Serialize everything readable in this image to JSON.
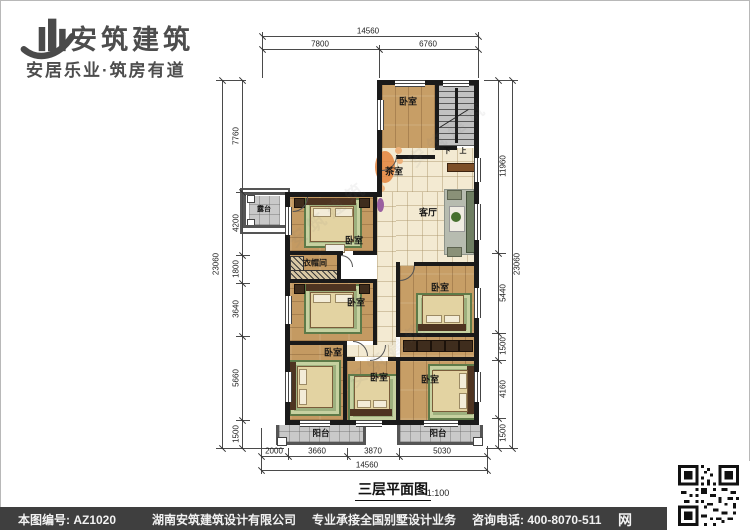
{
  "brand": {
    "name": "安筑建筑",
    "tagline": "安居乐业·筑房有道"
  },
  "plan": {
    "title": "三层平面图",
    "scale": "1:100",
    "rooms": [
      {
        "key": "bedroom-top",
        "label": "卧室"
      },
      {
        "key": "tea-room",
        "label": "茶室"
      },
      {
        "key": "living-room",
        "label": "客厅"
      },
      {
        "key": "bedroom-mid-left",
        "label": "卧室"
      },
      {
        "key": "cloakroom",
        "label": "衣帽间"
      },
      {
        "key": "bedroom-left-lower",
        "label": "卧室"
      },
      {
        "key": "bedroom-mid-right",
        "label": "卧室"
      },
      {
        "key": "bedroom-bottom-left",
        "label": "卧室"
      },
      {
        "key": "bedroom-bottom-middle",
        "label": "卧室"
      },
      {
        "key": "bedroom-bottom-right",
        "label": "卧室"
      },
      {
        "key": "terrace",
        "label": "露台"
      },
      {
        "key": "balcony-left",
        "label": "阳台"
      },
      {
        "key": "balcony-right",
        "label": "阳台"
      }
    ],
    "stairs": {
      "up": "上",
      "down": "下"
    },
    "dimensions": {
      "top": {
        "overall": "14560",
        "segments": [
          "7800",
          "6760"
        ]
      },
      "bottom": {
        "overall": "14560",
        "segments": [
          "2000",
          "3660",
          "3870",
          "5030"
        ]
      },
      "left": {
        "overall": "23060",
        "segments": [
          "7760",
          "4200",
          "1800",
          "3640",
          "5660",
          "1500"
        ]
      },
      "right": {
        "overall": "23060",
        "segments": [
          "11960",
          "5440",
          "1500",
          "4160",
          "1500"
        ]
      }
    }
  },
  "watermark": "安筑建筑",
  "footer": {
    "drawing_no": "本图编号: AZ1020",
    "company": "湖南安筑建筑设计有限公司",
    "service": "专业承接全国别墅设计业务",
    "phone": "咨询电话: 400-8070-511",
    "web_badge": "网"
  },
  "colors": {
    "wood": "#c79e66",
    "tile": "#f3ead2",
    "wall": "#1a1a1a",
    "footer_bg": "#3f3f3f",
    "accent_orange": "#e2833c"
  }
}
